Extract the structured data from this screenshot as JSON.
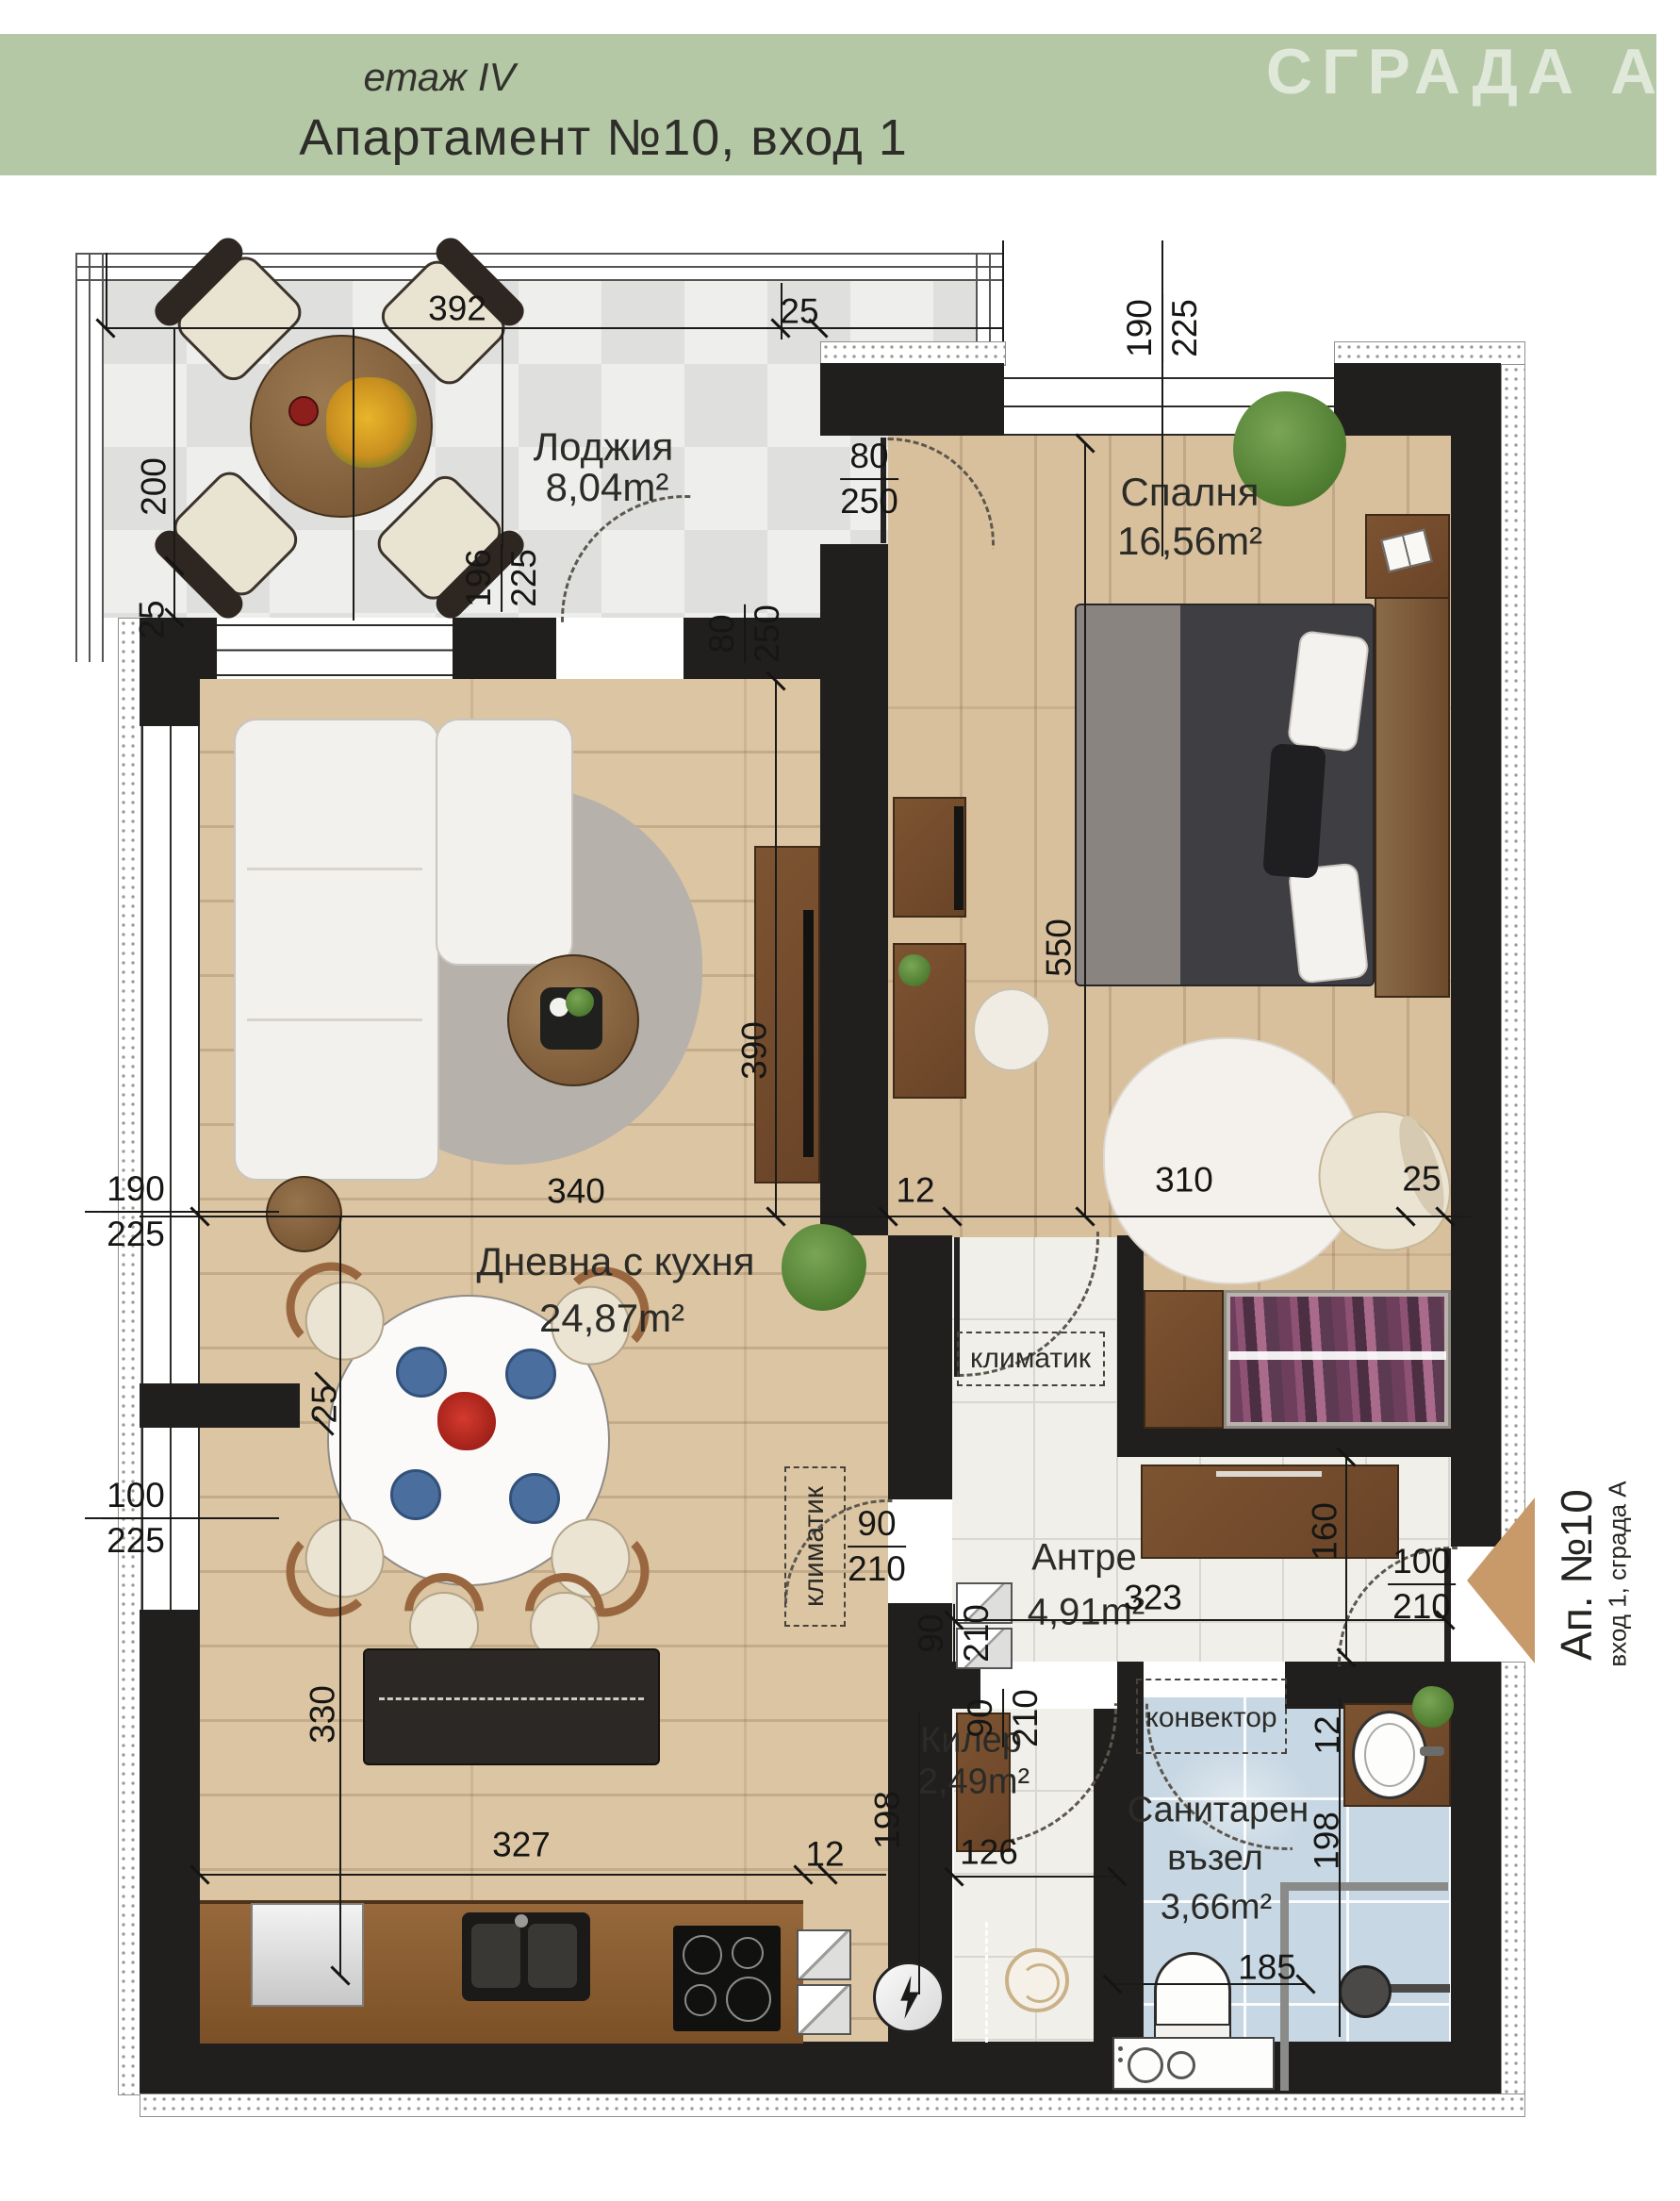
{
  "header": {
    "floor": "етаж IV",
    "title": "Апартамент №10, вход 1",
    "building": "СГРАДА А",
    "accent_color": "#b5c8a6"
  },
  "rooms": {
    "loggia": {
      "name": "Лоджия",
      "area": "8,04m²"
    },
    "bedroom": {
      "name": "Спалня",
      "area": "16,56m²"
    },
    "living": {
      "name": "Дневна с кухня",
      "area": "24,87m²"
    },
    "hall": {
      "name": "Антре",
      "area": "4,91m²"
    },
    "storage": {
      "name": "Килер",
      "area": "2,49m²"
    },
    "bath": {
      "name_line1": "Санитарен",
      "name_line2": "възел",
      "area": "3,66m²"
    }
  },
  "annotations": {
    "ac_hall": "климатик",
    "ac_storage": "климатик",
    "convector": "конвектор",
    "entrance_title": "Ап. №10",
    "entrance_sub": "вход 1, сграда А"
  },
  "dims": {
    "d392": "392",
    "d25_top": "25",
    "d200": "200",
    "d25_loggia": "25",
    "w190_225_top": {
      "num": "190",
      "den": "225"
    },
    "f80_250_bedroom": {
      "num": "80",
      "den": "250"
    },
    "f80_250_living": {
      "num": "80",
      "den": "250"
    },
    "f196_225": {
      "num": "196",
      "den": "225"
    },
    "d550": "550",
    "d390": "390",
    "d340": "340",
    "d12_mid": "12",
    "d310": "310",
    "d25_right": "25",
    "w190_225_left": {
      "num": "190",
      "den": "225"
    },
    "d25_pier": "25",
    "w100_225_left": {
      "num": "100",
      "den": "225"
    },
    "d323": "323",
    "d160": "160",
    "f100_210_entry": {
      "num": "100",
      "den": "210"
    },
    "f90_210_hall": {
      "num": "90",
      "den": "210"
    },
    "f90_210_storage": {
      "num": "90",
      "den": "210"
    },
    "f90_210_bath": {
      "num": "90",
      "den": "210"
    },
    "d327": "327",
    "d12_kitchen": "12",
    "d126": "126",
    "d198_storage": "198",
    "d12_bath": "12",
    "d198_bath": "198",
    "d185": "185",
    "d330": "330"
  },
  "colors": {
    "wall": "#211f1d",
    "wood_living": "#dcc5a3",
    "wood_bedroom": "#d9c09d",
    "loggia_tile": "#e7e7e5",
    "hall_tile": "#f1efe9",
    "bath_tile": "#c7d7e3",
    "entrance_arrow": "#c89a6a"
  }
}
